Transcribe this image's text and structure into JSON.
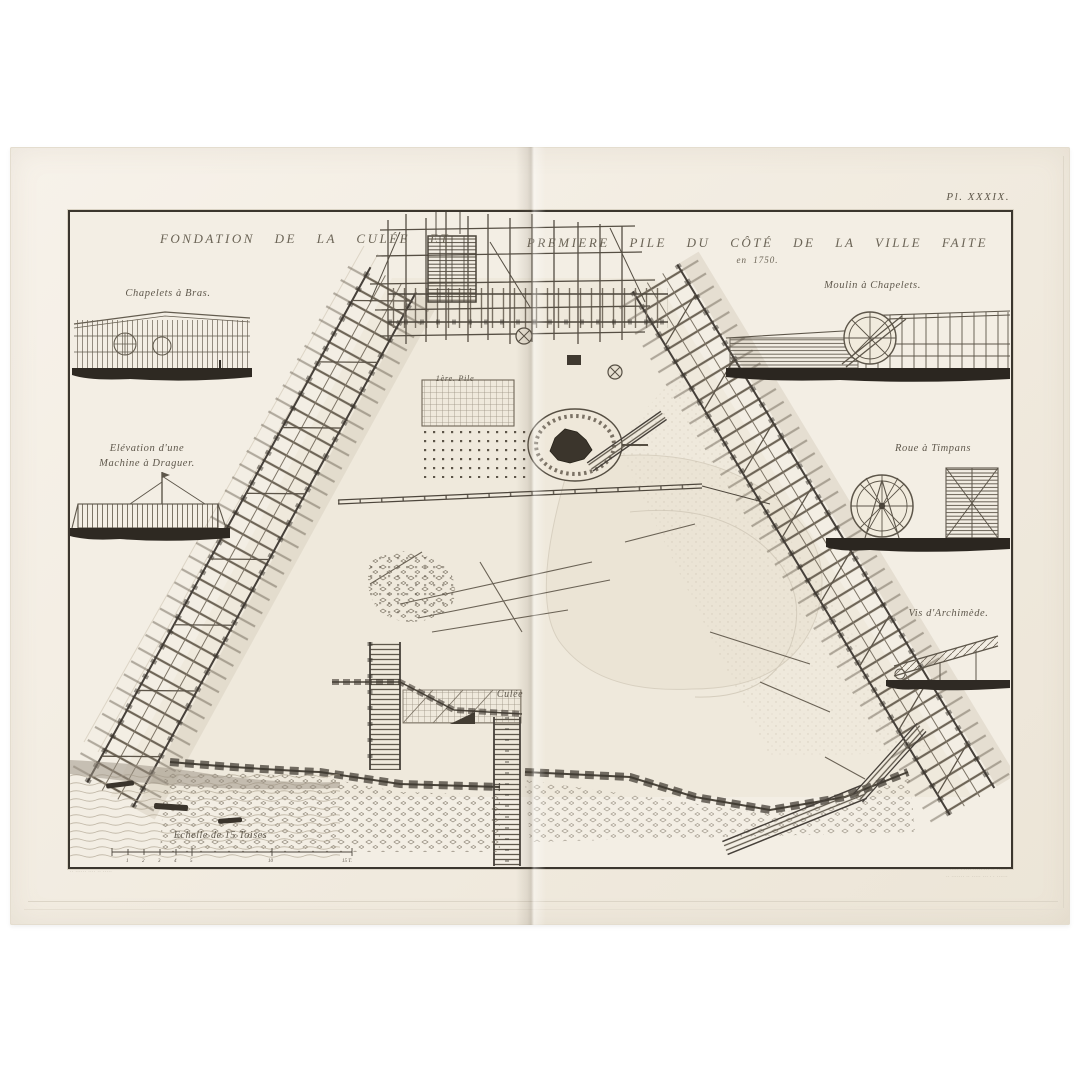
{
  "plate": {
    "number": "Pl. XXXIX.",
    "title": {
      "left": "FONDATION DE LA CULÉE ET",
      "right": "PREMIERE PILE DU CÔTÉ DE LA VILLE FAITE",
      "year": "en 1750."
    },
    "ink_color": "#564f44",
    "paper_color": "#f2ece1",
    "vignettes": [
      {
        "id": "chapelets-a-bras",
        "label": "Chapelets à Bras."
      },
      {
        "id": "machine-a-draguer",
        "label_line1": "Elévation d'une",
        "label_line2": "Machine à Draguer."
      },
      {
        "id": "moulin-a-chapelets",
        "label": "Moulin à Chapelets."
      },
      {
        "id": "roue-a-timpans",
        "label": "Roue à Timpans"
      },
      {
        "id": "vis-archimede",
        "label": "Vis d'Archimède."
      }
    ],
    "plan_labels": {
      "pile": "1ère. Pile",
      "culee": "Culée"
    },
    "scale": {
      "label": "Echelle de 15 Toises",
      "ticks": [
        "1",
        "2",
        "3",
        "4",
        "5",
        "10",
        "15 T."
      ]
    },
    "credits": {
      "left": "·· ······ ···· ·· ·····",
      "right_line1": "····· · ···· ····· ··· ·· ······",
      "right_line2": "·· ······· ·· ····· ··· · · ······"
    }
  }
}
